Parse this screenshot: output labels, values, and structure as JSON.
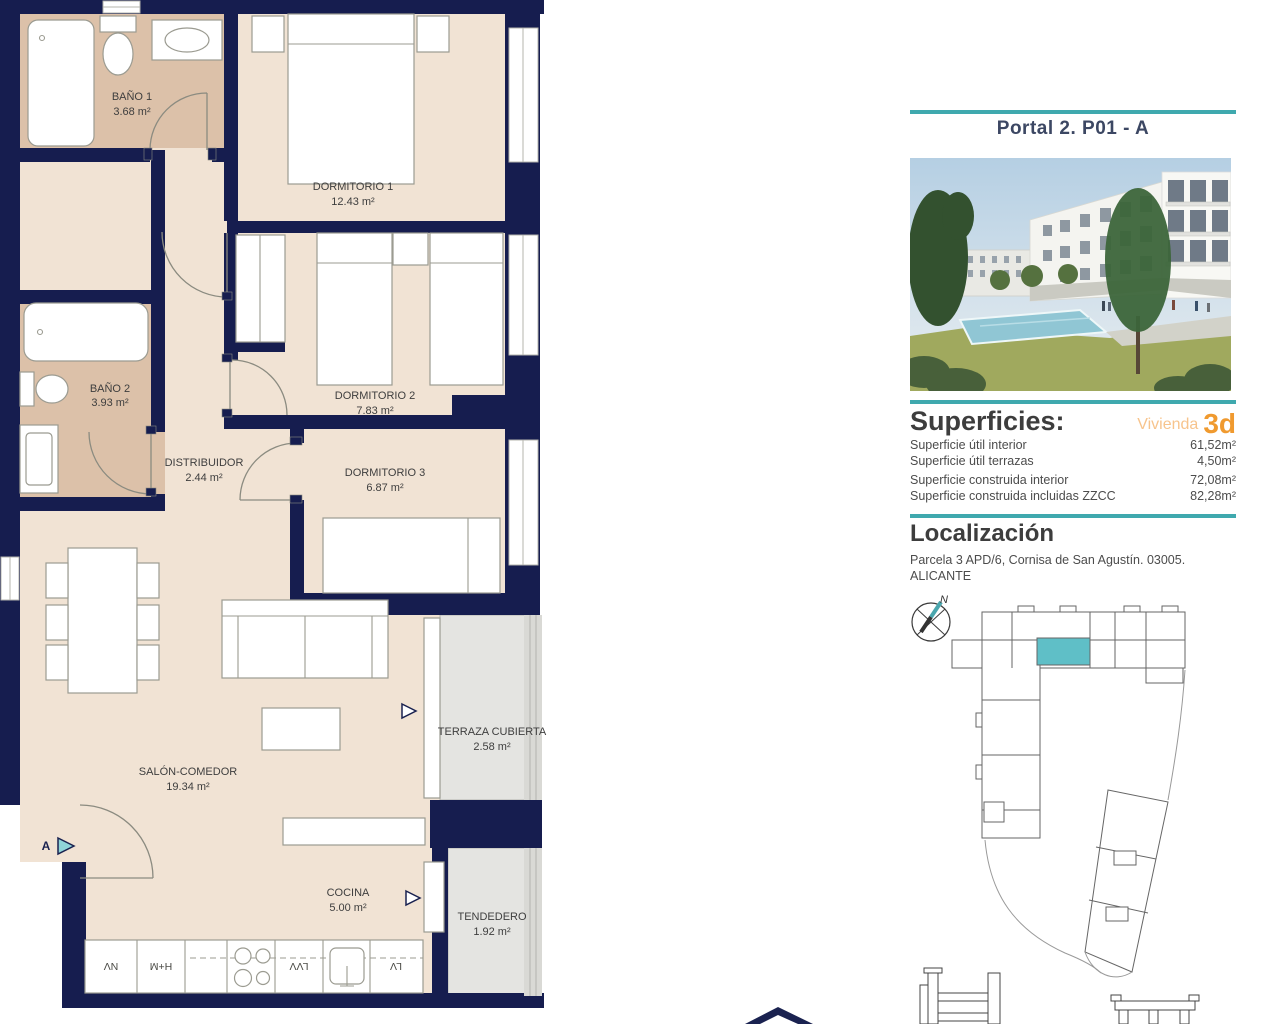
{
  "floorplan": {
    "rooms": [
      {
        "name": "BAÑO 1",
        "area": "3.68 m²"
      },
      {
        "name": "DORMITORIO 1",
        "area": "12.43 m²"
      },
      {
        "name": "DORMITORIO 2",
        "area": "7.83 m²"
      },
      {
        "name": "BAÑO 2",
        "area": "3.93 m²"
      },
      {
        "name": "DISTRIBUIDOR",
        "area": "2.44 m²"
      },
      {
        "name": "DORMITORIO 3",
        "area": "6.87 m²"
      },
      {
        "name": "SALÓN-COMEDOR",
        "area": "19.34 m²"
      },
      {
        "name": "TERRAZA CUBIERTA",
        "area": "2.58 m²"
      },
      {
        "name": "COCINA",
        "area": "5.00 m²"
      },
      {
        "name": "TENDEDERO",
        "area": "1.92 m²"
      }
    ],
    "entrance_label": "A",
    "kitchen_appliances": [
      "NV",
      "H+M",
      "LVV",
      "LV"
    ]
  },
  "panel": {
    "title": "Portal 2. P01 - A",
    "superficies": {
      "heading": "Superficies:",
      "vivienda_label": "Vivienda",
      "vivienda_value": "3d",
      "rows": [
        {
          "label": "Superficie útil interior",
          "value": "61,52m²"
        },
        {
          "label": "Superficie útil terrazas",
          "value": "4,50m²"
        },
        {
          "label": "Superficie construida interior",
          "value": "72,08m²"
        },
        {
          "label": "Superficie construida incluidas ZZCC",
          "value": "82,28m²"
        }
      ]
    },
    "localizacion": {
      "heading": "Localización",
      "address_line1": "Parcela 3 APD/6, Cornisa de San Agustín. 03005.",
      "address_line2": "ALICANTE",
      "compass_label": "N"
    }
  },
  "colors": {
    "wall_navy": "#161d4f",
    "floor_beige": "#f1e3d4",
    "floor_bath_tan": "#dcc1a9",
    "floor_terrace_gray": "#e4e4e1",
    "accent_teal": "#3fa9ae",
    "highlight_unit_teal": "#5fbfc7",
    "accent_orange": "#f09a2f",
    "title_blue": "#3c4763"
  }
}
